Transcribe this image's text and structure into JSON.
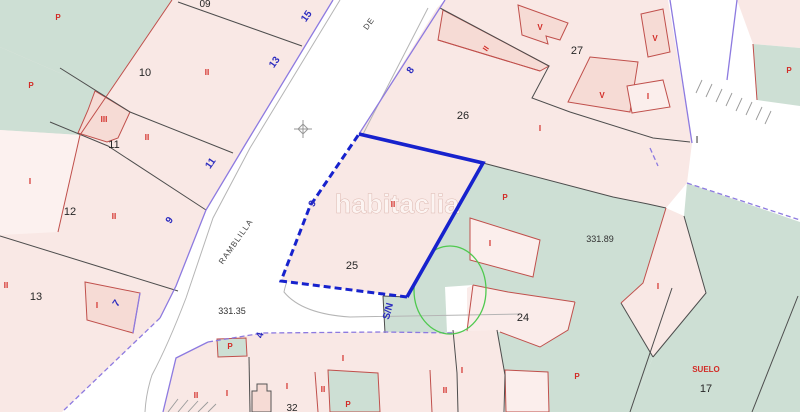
{
  "watermark": {
    "text": "habitaclia"
  },
  "streets": {
    "name_main": "RAMBLILLA",
    "name_prefix": "DE"
  },
  "elevation_labels": [
    {
      "text": "331.35"
    },
    {
      "text": "331.89"
    }
  ],
  "parcel_numbers": [
    {
      "text": "09"
    },
    {
      "text": "10"
    },
    {
      "text": "11"
    },
    {
      "text": "12"
    },
    {
      "text": "13"
    },
    {
      "text": "25"
    },
    {
      "text": "26"
    },
    {
      "text": "27"
    },
    {
      "text": "24"
    },
    {
      "text": "17"
    },
    {
      "text": "32"
    },
    {
      "text": "I"
    }
  ],
  "house_numbers": [
    {
      "text": "15"
    },
    {
      "text": "13"
    },
    {
      "text": "11"
    },
    {
      "text": "9"
    },
    {
      "text": "7"
    },
    {
      "text": "8"
    },
    {
      "text": "9"
    },
    {
      "text": "4"
    },
    {
      "text": "S/N"
    }
  ],
  "floor_labels": [
    {
      "text": "P"
    },
    {
      "text": "P"
    },
    {
      "text": "I"
    },
    {
      "text": "III"
    },
    {
      "text": "II"
    },
    {
      "text": "II"
    },
    {
      "text": "II"
    },
    {
      "text": "II"
    },
    {
      "text": "I"
    },
    {
      "text": "II"
    },
    {
      "text": "I"
    },
    {
      "text": "V"
    },
    {
      "text": "V"
    },
    {
      "text": "V"
    },
    {
      "text": "I"
    },
    {
      "text": "P"
    },
    {
      "text": "I"
    },
    {
      "text": "P"
    },
    {
      "text": "I"
    },
    {
      "text": "II"
    },
    {
      "text": "P"
    },
    {
      "text": "I"
    },
    {
      "text": "II"
    },
    {
      "text": "P"
    },
    {
      "text": "II"
    },
    {
      "text": "I"
    },
    {
      "text": "I"
    },
    {
      "text": "II"
    },
    {
      "text": "P"
    },
    {
      "text": "I"
    },
    {
      "text": "SUELO"
    }
  ],
  "colors": {
    "parcel_pink": "#f9e8e5",
    "parcel_green": "#cddfd4",
    "building_pink": "#f6dbd5",
    "highlight_blue": "#1722cd",
    "house_number_blue": "#2b2bbf",
    "floor_label_red": "#d22b26",
    "boundary_black": "#4d4d4d",
    "boundary_red": "#c0504c",
    "cadastral_purple": "#8d7ae0",
    "overlay_green": "#4fc94f"
  }
}
